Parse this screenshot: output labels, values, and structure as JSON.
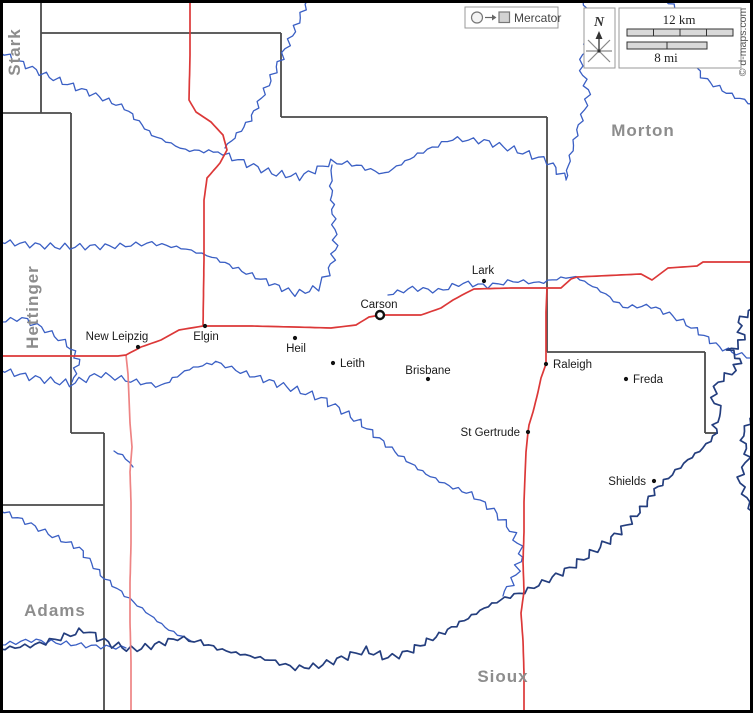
{
  "copyright": "© d-maps.com",
  "legend": {
    "projection_label": "Mercator"
  },
  "compass": {
    "north_label": "N"
  },
  "scale_bar": {
    "km_label": "12 km",
    "mi_label": "8 mi"
  },
  "colors": {
    "road_main": "#dc3838",
    "road_secondary": "#ee8484",
    "river_light": "#3a5fc4",
    "river_dark": "#243e7e",
    "boundary": "#4a4a4a",
    "county_label": "#8d8d8d",
    "town_dot": "#111111",
    "frame": "#000000"
  },
  "counties": [
    {
      "name": "Stark",
      "x": 20,
      "y": 52,
      "rotated": true
    },
    {
      "name": "Hettinger",
      "x": 38,
      "y": 307,
      "rotated": true
    },
    {
      "name": "Morton",
      "x": 643,
      "y": 136,
      "rotated": false
    },
    {
      "name": "Adams",
      "x": 55,
      "y": 616,
      "rotated": false
    },
    {
      "name": "Sioux",
      "x": 503,
      "y": 682,
      "rotated": false
    }
  ],
  "towns": [
    {
      "name": "Carson",
      "dot": [
        380,
        315
      ],
      "label": [
        379,
        308
      ],
      "anchor": "middle",
      "seat": true,
      "size": 15.5
    },
    {
      "name": "New Leipzig",
      "dot": [
        138,
        347
      ],
      "label": [
        117,
        340
      ],
      "anchor": "middle",
      "seat": false,
      "size": 11.5
    },
    {
      "name": "Elgin",
      "dot": [
        205,
        326
      ],
      "label": [
        206,
        340
      ],
      "anchor": "middle",
      "seat": false,
      "size": 11.5
    },
    {
      "name": "Heil",
      "dot": [
        295,
        338
      ],
      "label": [
        296,
        352
      ],
      "anchor": "middle",
      "seat": false,
      "size": 11.5
    },
    {
      "name": "Leith",
      "dot": [
        333,
        363
      ],
      "label": [
        340,
        367
      ],
      "anchor": "start",
      "seat": false,
      "size": 11.5
    },
    {
      "name": "Brisbane",
      "dot": [
        428,
        379
      ],
      "label": [
        428,
        374
      ],
      "anchor": "middle",
      "seat": false,
      "size": 11.5
    },
    {
      "name": "Lark",
      "dot": [
        484,
        281
      ],
      "label": [
        483,
        274
      ],
      "anchor": "middle",
      "seat": false,
      "size": 11.5
    },
    {
      "name": "Raleigh",
      "dot": [
        546,
        364
      ],
      "label": [
        553,
        368
      ],
      "anchor": "start",
      "seat": false,
      "size": 11.5
    },
    {
      "name": "Freda",
      "dot": [
        626,
        379
      ],
      "label": [
        633,
        383
      ],
      "anchor": "start",
      "seat": false,
      "size": 11.5
    },
    {
      "name": "St Gertrude",
      "dot": [
        528,
        432
      ],
      "label": [
        520,
        436
      ],
      "anchor": "end",
      "seat": false,
      "size": 11.5
    },
    {
      "name": "Shields",
      "dot": [
        654,
        481
      ],
      "label": [
        646,
        485
      ],
      "anchor": "end",
      "seat": false,
      "size": 11.5
    }
  ],
  "map_features": {
    "boundaries": [
      [
        [
          41,
          0
        ],
        [
          41,
          113
        ]
      ],
      [
        [
          0,
          113
        ],
        [
          71,
          113
        ]
      ],
      [
        [
          71,
          113
        ],
        [
          71,
          433
        ]
      ],
      [
        [
          71,
          433
        ],
        [
          104,
          433
        ]
      ],
      [
        [
          104,
          433
        ],
        [
          104,
          713
        ]
      ],
      [
        [
          0,
          505
        ],
        [
          104,
          505
        ]
      ],
      [
        [
          41,
          33
        ],
        [
          281,
          33
        ]
      ],
      [
        [
          281,
          33
        ],
        [
          281,
          117
        ]
      ],
      [
        [
          281,
          117
        ],
        [
          547,
          117
        ]
      ],
      [
        [
          547,
          117
        ],
        [
          547,
          352
        ]
      ],
      [
        [
          547,
          352
        ],
        [
          705,
          352
        ]
      ],
      [
        [
          705,
          352
        ],
        [
          705,
          433
        ]
      ],
      [
        [
          705,
          433
        ],
        [
          718,
          433
        ]
      ]
    ],
    "rivers_light": [
      {
        "amp": 2.2,
        "pts": [
          [
            0,
            52
          ],
          [
            45,
            75
          ],
          [
            95,
            95
          ],
          [
            125,
            108
          ],
          [
            152,
            135
          ],
          [
            185,
            150
          ],
          [
            218,
            152
          ]
        ]
      },
      {
        "amp": 2.0,
        "pts": [
          [
            308,
            0
          ],
          [
            290,
            40
          ],
          [
            268,
            85
          ],
          [
            250,
            120
          ],
          [
            225,
            148
          ]
        ]
      },
      {
        "amp": 2.5,
        "pts": [
          [
            218,
            152
          ],
          [
            248,
            164
          ],
          [
            272,
            173
          ],
          [
            300,
            177
          ],
          [
            332,
            162
          ],
          [
            352,
            164
          ],
          [
            384,
            174
          ],
          [
            418,
            154
          ],
          [
            452,
            139
          ],
          [
            484,
            141
          ],
          [
            518,
            151
          ],
          [
            548,
            161
          ],
          [
            566,
            179
          ]
        ]
      },
      {
        "amp": 2.3,
        "pts": [
          [
            0,
            242
          ],
          [
            60,
            247
          ],
          [
            120,
            246
          ],
          [
            152,
            243
          ],
          [
            186,
            249
          ],
          [
            212,
            257
          ],
          [
            242,
            271
          ],
          [
            270,
            283
          ],
          [
            296,
            294
          ],
          [
            318,
            288
          ],
          [
            330,
            269
          ],
          [
            336,
            245
          ],
          [
            333,
            214
          ],
          [
            331,
            186
          ],
          [
            332,
            165
          ]
        ]
      },
      {
        "amp": 2.0,
        "pts": [
          [
            583,
            0
          ],
          [
            591,
            30
          ],
          [
            580,
            65
          ],
          [
            589,
            95
          ],
          [
            576,
            135
          ],
          [
            568,
            166
          ],
          [
            566,
            180
          ]
        ]
      },
      {
        "amp": 2.0,
        "pts": [
          [
            665,
            0
          ],
          [
            688,
            18
          ],
          [
            700,
            38
          ],
          [
            689,
            60
          ],
          [
            706,
            80
          ],
          [
            731,
            95
          ],
          [
            753,
            104
          ]
        ]
      },
      {
        "amp": 1.8,
        "pts": [
          [
            388,
            295
          ],
          [
            413,
            288
          ],
          [
            438,
            291
          ],
          [
            463,
            283
          ],
          [
            488,
            286
          ],
          [
            513,
            281
          ],
          [
            539,
            283
          ],
          [
            561,
            278
          ],
          [
            576,
            277
          ],
          [
            601,
            291
          ],
          [
            623,
            307
          ],
          [
            651,
            306
          ],
          [
            673,
            316
          ],
          [
            696,
            330
          ],
          [
            719,
            347
          ],
          [
            741,
            355
          ],
          [
            753,
            358
          ]
        ]
      },
      {
        "amp": 2.6,
        "pts": [
          [
            0,
            370
          ],
          [
            35,
            378
          ],
          [
            70,
            384
          ],
          [
            100,
            374
          ],
          [
            131,
            381
          ],
          [
            161,
            386
          ],
          [
            189,
            369
          ],
          [
            216,
            362
          ],
          [
            241,
            372
          ],
          [
            269,
            381
          ],
          [
            296,
            390
          ],
          [
            321,
            398
          ],
          [
            343,
            411
          ],
          [
            363,
            425
          ],
          [
            383,
            442
          ],
          [
            403,
            458
          ],
          [
            426,
            474
          ],
          [
            449,
            486
          ],
          [
            471,
            494
          ],
          [
            493,
            510
          ],
          [
            511,
            530
          ],
          [
            522,
            552
          ],
          [
            516,
            575
          ],
          [
            503,
            596
          ]
        ]
      },
      {
        "amp": 2.0,
        "pts": [
          [
            0,
            322
          ],
          [
            22,
            318
          ],
          [
            46,
            330
          ],
          [
            68,
            345
          ],
          [
            79,
            360
          ],
          [
            72,
            382
          ]
        ]
      },
      {
        "amp": 1.8,
        "pts": [
          [
            0,
            510
          ],
          [
            26,
            522
          ],
          [
            53,
            536
          ],
          [
            79,
            548
          ],
          [
            101,
            575
          ],
          [
            121,
            592
          ],
          [
            146,
            612
          ],
          [
            169,
            630
          ],
          [
            191,
            641
          ]
        ]
      },
      {
        "amp": 1.6,
        "pts": [
          [
            0,
            645
          ],
          [
            31,
            640
          ],
          [
            61,
            643
          ],
          [
            91,
            646
          ],
          [
            126,
            648
          ]
        ]
      },
      {
        "amp": 1.0,
        "pts": [
          [
            114,
            451
          ],
          [
            126,
            458
          ],
          [
            133,
            467
          ]
        ]
      }
    ],
    "rivers_dark": [
      {
        "amp": 2.6,
        "pts": [
          [
            753,
            308
          ],
          [
            738,
            322
          ],
          [
            744,
            340
          ],
          [
            728,
            352
          ],
          [
            740,
            358
          ],
          [
            735,
            370
          ],
          [
            718,
            382
          ],
          [
            712,
            398
          ],
          [
            722,
            412
          ],
          [
            714,
            426
          ],
          [
            717,
            433
          ],
          [
            703,
            448
          ],
          [
            688,
            460
          ],
          [
            668,
            478
          ],
          [
            655,
            490
          ],
          [
            645,
            505
          ],
          [
            630,
            522
          ],
          [
            612,
            538
          ],
          [
            592,
            553
          ],
          [
            570,
            568
          ],
          [
            548,
            580
          ],
          [
            524,
            592
          ],
          [
            505,
            598
          ],
          [
            488,
            606
          ],
          [
            468,
            618
          ],
          [
            448,
            630
          ],
          [
            428,
            641
          ],
          [
            408,
            652
          ],
          [
            388,
            658
          ],
          [
            365,
            650
          ],
          [
            342,
            658
          ],
          [
            318,
            666
          ],
          [
            295,
            668
          ],
          [
            270,
            660
          ],
          [
            245,
            655
          ],
          [
            222,
            650
          ],
          [
            200,
            642
          ],
          [
            178,
            638
          ],
          [
            155,
            645
          ],
          [
            132,
            650
          ],
          [
            108,
            643
          ],
          [
            85,
            630
          ],
          [
            60,
            638
          ],
          [
            35,
            645
          ],
          [
            0,
            649
          ]
        ]
      },
      {
        "amp": 2.0,
        "pts": [
          [
            753,
            415
          ],
          [
            742,
            435
          ],
          [
            748,
            458
          ],
          [
            739,
            478
          ],
          [
            746,
            498
          ],
          [
            753,
            512
          ]
        ]
      }
    ],
    "roads_main": [
      [
        [
          0,
          356
        ],
        [
          118,
          356
        ],
        [
          126,
          355
        ],
        [
          141,
          347
        ],
        [
          161,
          340
        ],
        [
          179,
          330
        ],
        [
          203,
          326
        ],
        [
          252,
          326
        ],
        [
          294,
          327
        ],
        [
          331,
          328
        ],
        [
          356,
          325
        ],
        [
          369,
          317
        ],
        [
          381,
          315
        ],
        [
          421,
          315
        ],
        [
          441,
          308
        ],
        [
          453,
          300
        ],
        [
          466,
          293
        ],
        [
          474,
          289
        ],
        [
          511,
          288
        ],
        [
          547,
          288
        ],
        [
          561,
          288
        ],
        [
          571,
          279
        ],
        [
          577,
          277
        ],
        [
          641,
          274
        ],
        [
          652,
          280
        ],
        [
          668,
          268
        ],
        [
          697,
          266
        ],
        [
          703,
          262
        ],
        [
          753,
          262
        ]
      ],
      [
        [
          190,
          0
        ],
        [
          190,
          55
        ],
        [
          189,
          100
        ],
        [
          196,
          112
        ],
        [
          211,
          122
        ],
        [
          223,
          135
        ],
        [
          227,
          150
        ],
        [
          220,
          163
        ],
        [
          207,
          178
        ],
        [
          204,
          200
        ],
        [
          204,
          260
        ],
        [
          203,
          326
        ]
      ],
      [
        [
          547,
          288
        ],
        [
          546,
          312
        ],
        [
          546,
          342
        ],
        [
          546,
          364
        ],
        [
          541,
          378
        ],
        [
          538,
          392
        ],
        [
          533,
          412
        ],
        [
          529,
          425
        ],
        [
          528,
          432
        ],
        [
          526,
          452
        ],
        [
          525,
          476
        ],
        [
          524,
          502
        ],
        [
          524,
          532
        ],
        [
          523,
          562
        ],
        [
          524,
          591
        ],
        [
          521,
          613
        ],
        [
          523,
          641
        ],
        [
          524,
          673
        ],
        [
          524,
          713
        ]
      ]
    ],
    "roads_secondary": [
      [
        [
          126,
          355
        ],
        [
          128,
          374
        ],
        [
          129,
          398
        ],
        [
          130,
          423
        ],
        [
          132,
          447
        ],
        [
          130,
          472
        ],
        [
          131,
          502
        ],
        [
          131,
          543
        ],
        [
          130,
          583
        ],
        [
          130,
          622
        ],
        [
          131,
          662
        ],
        [
          131,
          713
        ]
      ]
    ]
  }
}
